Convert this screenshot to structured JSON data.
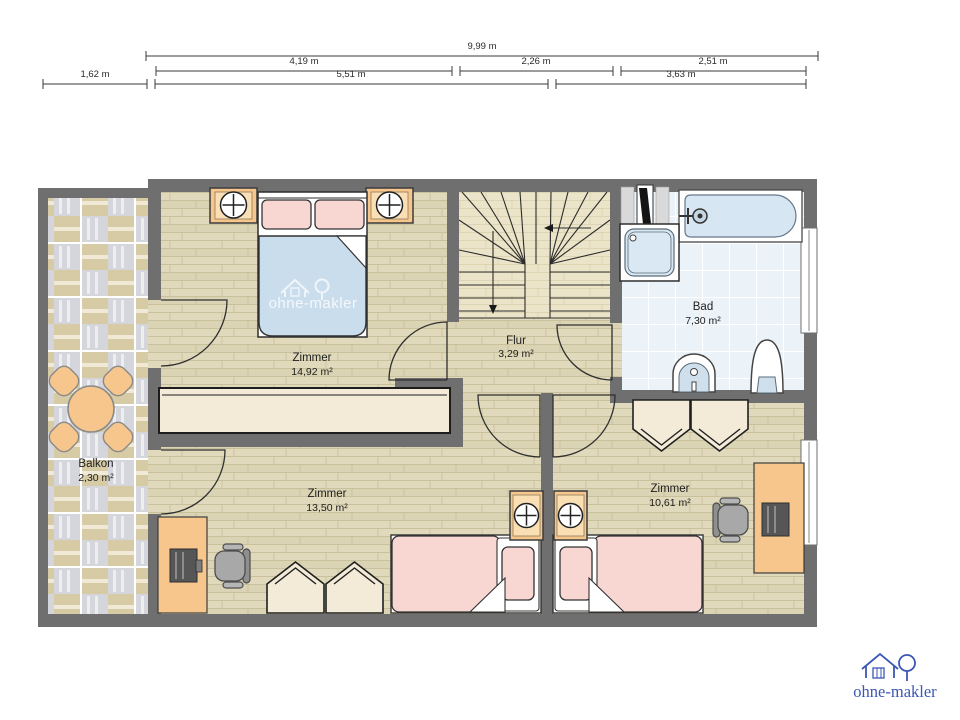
{
  "dimensions": {
    "total": "9,99 m",
    "row2": [
      "4,19 m",
      "2,26 m",
      "2,51 m"
    ],
    "row3": [
      "1,62 m",
      "5,51 m",
      "3,63 m"
    ]
  },
  "rooms": {
    "bedroom": {
      "name": "Zimmer",
      "area": "14,92 m²"
    },
    "hall": {
      "name": "Flur",
      "area": "3,29 m²"
    },
    "bath": {
      "name": "Bad",
      "area": "7,30 m²"
    },
    "room_bottom_left": {
      "name": "Zimmer",
      "area": "13,50 m²"
    },
    "room_bottom_right": {
      "name": "Zimmer",
      "area": "10,61 m²"
    },
    "balcony": {
      "name": "Balkon",
      "area": "2,30 m²"
    }
  },
  "brand": {
    "watermark": "ohne-makler",
    "logo": "ohne-makler"
  },
  "colors": {
    "wall": "#6f6f6f",
    "wood_floor": "#e0d9bb",
    "stair_floor": "#ebe4c9",
    "bath_tile": "#ecf3f8",
    "balcony_beige": "#d7cba6",
    "balcony_gray": "#d4d6db",
    "furniture_orange": "#f6c68c",
    "textile_pink": "#f8d7d3",
    "blanket_blue": "#cadded",
    "cream": "#f3ebd7",
    "brand_blue": "#3b57b5"
  }
}
